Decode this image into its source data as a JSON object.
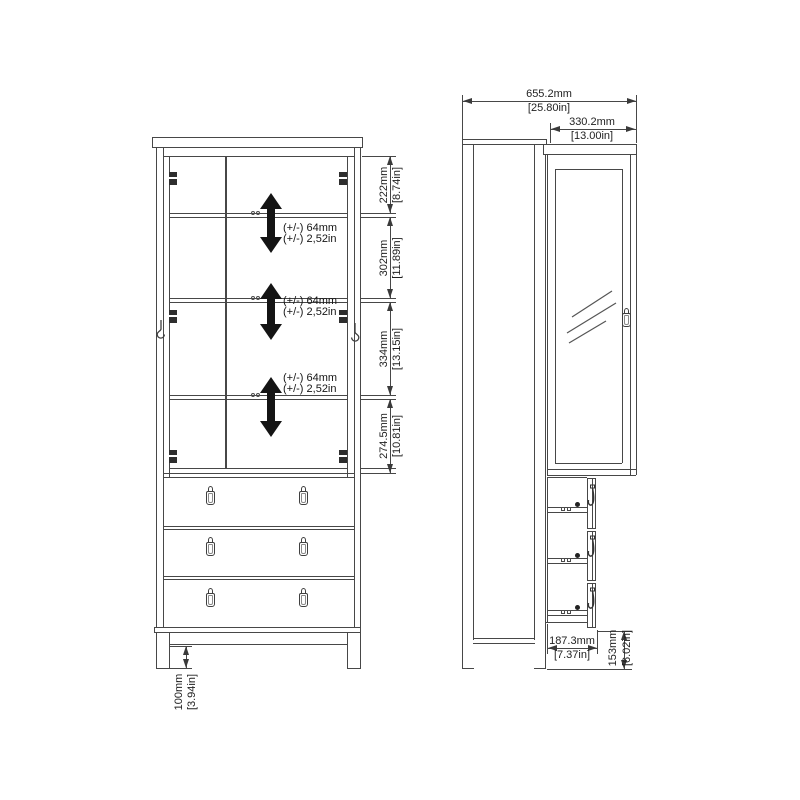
{
  "front_view": {
    "shelf_adjust_note": {
      "line1": "(+/-) 64mm",
      "line2": "(+/-) 2,52in"
    },
    "dimensions": {
      "section_1": {
        "mm": "222mm",
        "inch": "[8.74in]"
      },
      "section_2": {
        "mm": "302mm",
        "inch": "[11.89in]"
      },
      "section_3": {
        "mm": "334mm",
        "inch": "[13.15in]"
      },
      "section_4": {
        "mm": "274.5mm",
        "inch": "[10.81in]"
      },
      "leg_height": {
        "mm": "100mm",
        "inch": "[3.94in]"
      }
    }
  },
  "side_view": {
    "dimensions": {
      "total_depth_door_open": {
        "mm": "655.2mm",
        "inch": "[25.80in]"
      },
      "door_width": {
        "mm": "330.2mm",
        "inch": "[13.00in]"
      },
      "drawer_extension": {
        "mm": "187.3mm",
        "inch": "[7.37in]"
      },
      "drawer_front_height": {
        "mm": "153mm",
        "inch": "[6.02in]"
      }
    }
  },
  "colors": {
    "line": "#474747",
    "arrow": "#141414",
    "text": "#1f1f1f",
    "background": "#ffffff"
  }
}
